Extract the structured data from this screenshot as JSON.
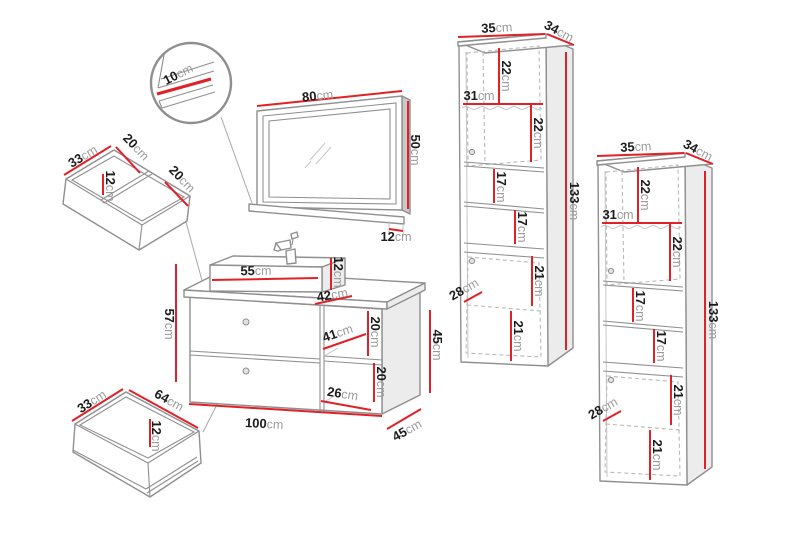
{
  "unit": "cm",
  "colors": {
    "dimension_line": "#e02128",
    "furniture_outline": "#8f8f8f"
  },
  "detail_zoom": {
    "frame_depth": "10"
  },
  "mirror": {
    "width": "80",
    "height": "50",
    "shelf_depth": "12"
  },
  "organizer_tray": {
    "width": "33",
    "compartment_1": "20",
    "height": "12",
    "compartment_2": "20"
  },
  "drawer": {
    "width": "33",
    "length": "64",
    "height": "12"
  },
  "washbasin_cabinet": {
    "basin_width": "55",
    "basin_height": "12",
    "basin_depth": "42",
    "total_height": "57",
    "shelf_width": "41",
    "shelf_upper_height": "20",
    "shelf_lower_height": "20",
    "shelf_lower_width": "26",
    "width": "100",
    "cabinet_height": "45",
    "depth": "45"
  },
  "tall_cabinet_left": {
    "width": "35",
    "depth": "34",
    "inner_width": "31",
    "upper_section_1": "22",
    "upper_section_2": "22",
    "open_shelf_1": "17",
    "open_shelf_2": "17",
    "lower_section_1": "21",
    "lower_section_2": "21",
    "door_width": "28",
    "height": "133"
  },
  "tall_cabinet_right": {
    "width": "35",
    "depth": "34",
    "inner_width": "31",
    "upper_section_1": "22",
    "upper_section_2": "22",
    "open_shelf_1": "17",
    "open_shelf_2": "17",
    "lower_section_1": "21",
    "lower_section_2": "21",
    "door_width": "28",
    "height": "133"
  }
}
